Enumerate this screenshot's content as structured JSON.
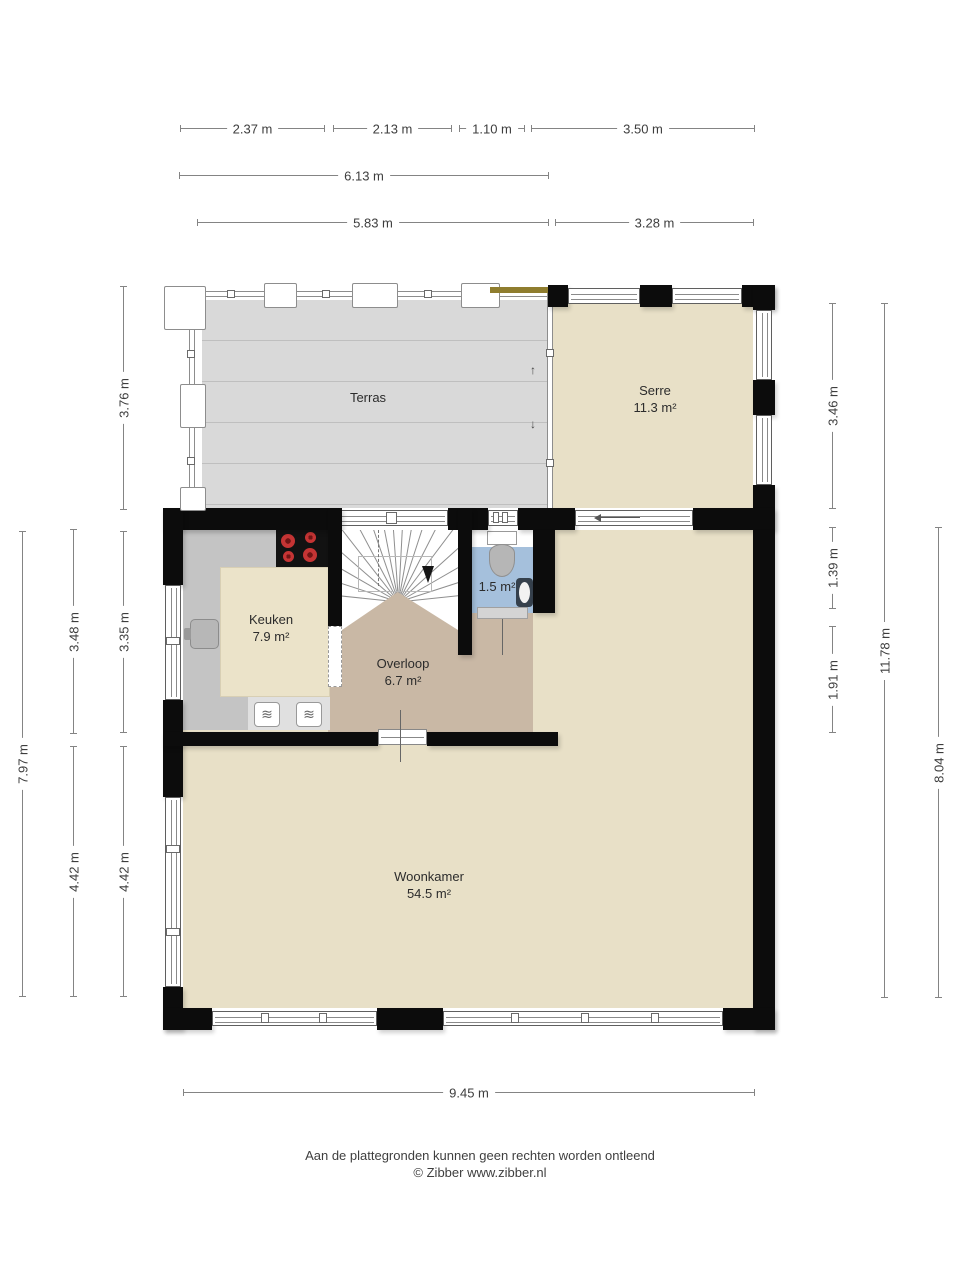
{
  "rooms": {
    "terras": {
      "name": "Terras"
    },
    "serre": {
      "name": "Serre",
      "area": "11.3 m²"
    },
    "keuken": {
      "name": "Keuken",
      "area": "7.9 m²"
    },
    "overloop": {
      "name": "Overloop",
      "area": "6.7 m²"
    },
    "toilet": {
      "area": "1.5 m²"
    },
    "woonkamer": {
      "name": "Woonkamer",
      "area": "54.5 m²"
    }
  },
  "dims": {
    "w237": "2.37 m",
    "w213": "2.13 m",
    "w110": "1.10 m",
    "w350": "3.50 m",
    "w613": "6.13 m",
    "w583": "5.83 m",
    "w328": "3.28 m",
    "w945": "9.45 m",
    "h797": "7.97 m",
    "h348": "3.48 m",
    "h442a": "4.42 m",
    "h376": "3.76 m",
    "h335": "3.35 m",
    "h442b": "4.42 m",
    "h346": "3.46 m",
    "h139": "1.39 m",
    "h191": "1.91 m",
    "h1178": "11.78 m",
    "h804": "8.04 m"
  },
  "icons": {
    "up_arrow": "↑",
    "down_arrow": "↓",
    "oven": "≋"
  },
  "footer": {
    "disclaimer": "Aan de plattegronden kunnen geen rechten worden ontleend",
    "copyright": "© Zibber www.zibber.nl"
  },
  "colors": {
    "wall": "#0c0c0c",
    "room_beige": "#e8e0c7",
    "overloop_tan": "#c9b8a5",
    "toilet_blue": "#a5c0dc",
    "terrace_gray": "#d9d9d9",
    "counter_gray": "#c4c4c4",
    "burner_red": "#c53434",
    "sunscreen_olive": "#8f7d2e"
  }
}
